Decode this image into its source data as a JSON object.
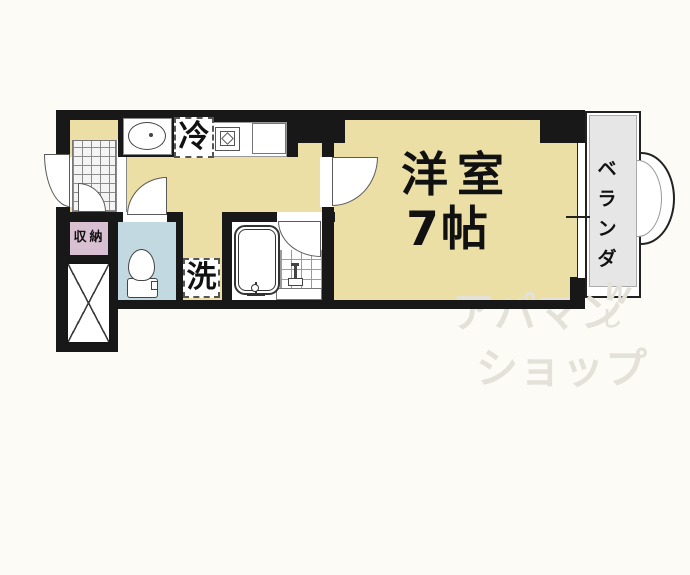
{
  "rooms": {
    "living": {
      "name": "洋室",
      "size": "7帖"
    },
    "balcony": {
      "name": "ベランダ",
      "chars": [
        "ベ",
        "ラ",
        "ン",
        "ダ"
      ]
    },
    "storage": {
      "name": "収納"
    },
    "appliances": {
      "refrigerator": "冷",
      "washer": "洗"
    }
  },
  "watermark": {
    "line1": "アパマン",
    "line2": "ショップ",
    "accent_w": "W",
    "accent_shi": "し"
  },
  "colors": {
    "background": "#FCFBF5",
    "wall": "#181818",
    "floor_tan": "#EBDFA6",
    "toilet_blue": "#C3D9E2",
    "storage_pink": "#D8C0D2",
    "balcony_gray": "#E6E6E6",
    "watermark": "#E3E1D8"
  }
}
